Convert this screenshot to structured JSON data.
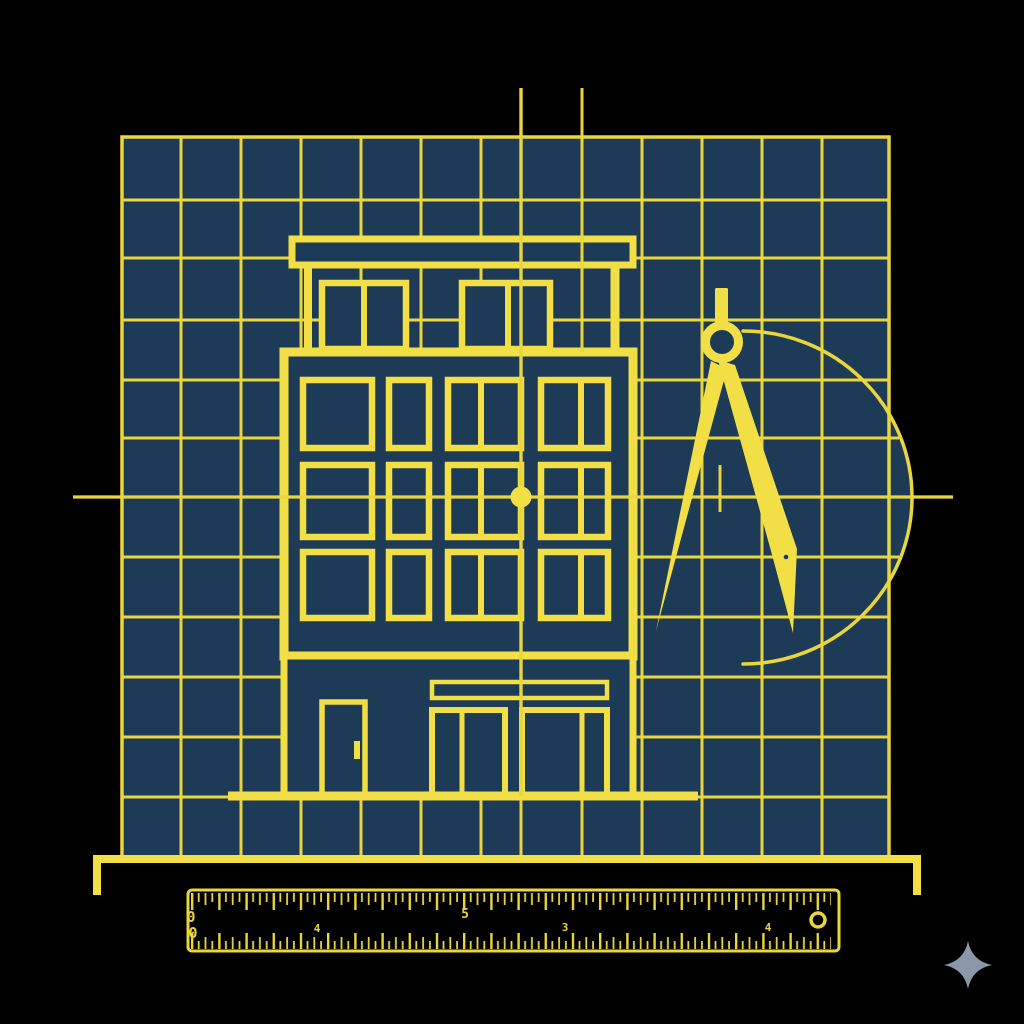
{
  "canvas": {
    "width": 1024,
    "height": 1024
  },
  "colors": {
    "background": "#000000",
    "line_yellow": "#e9d53c",
    "line_yellow_bright": "#f2df45",
    "navy": "#1d3a57",
    "sparkle_gray": "#8b98a9"
  },
  "scene": {
    "style": "blueprint",
    "elements": [
      "grid-paper",
      "building-elevation",
      "drafting-compass",
      "compass-arc",
      "center-crosshair",
      "ground-bracket",
      "ruler",
      "sparkle-logo"
    ]
  },
  "ruler": {
    "top_labels": [
      "0",
      "5"
    ],
    "bottom_labels": [
      "0",
      "4",
      "3",
      "4"
    ]
  },
  "icons": {
    "sparkle_icon": "four-point-star",
    "compass_icon": "drafting-compass",
    "ruler_icon": "measuring-ruler"
  }
}
